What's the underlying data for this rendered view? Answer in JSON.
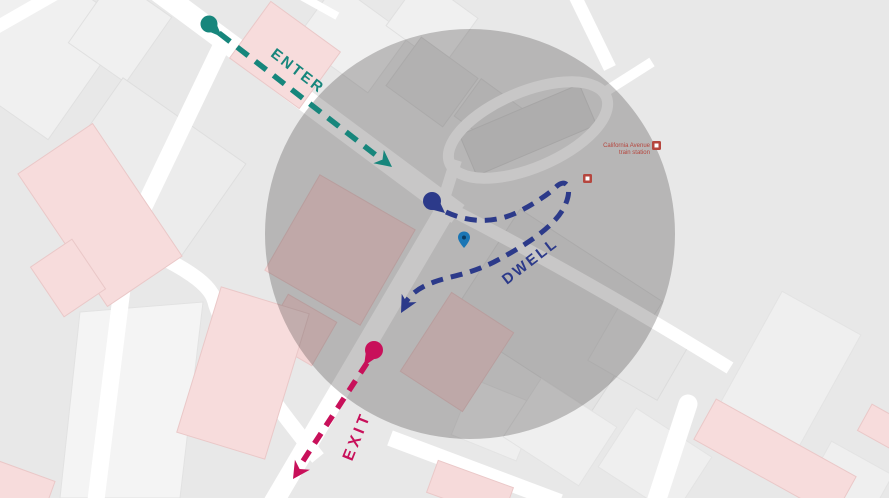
{
  "colors": {
    "enter": "#17867C",
    "dwell": "#2C3A8A",
    "exit": "#C8105A",
    "geofence_fill": "rgba(35,32,32,0.25)",
    "pin": "#1B76B5",
    "pin_center": "#0C3C63",
    "poi_red": "#B5463E"
  },
  "annotations": {
    "enter_label": "ENTER",
    "dwell_label": "DWELL",
    "exit_label": "EXIT"
  },
  "map": {
    "station_label_line1": "California Avenue",
    "station_label_line2": "train station"
  }
}
